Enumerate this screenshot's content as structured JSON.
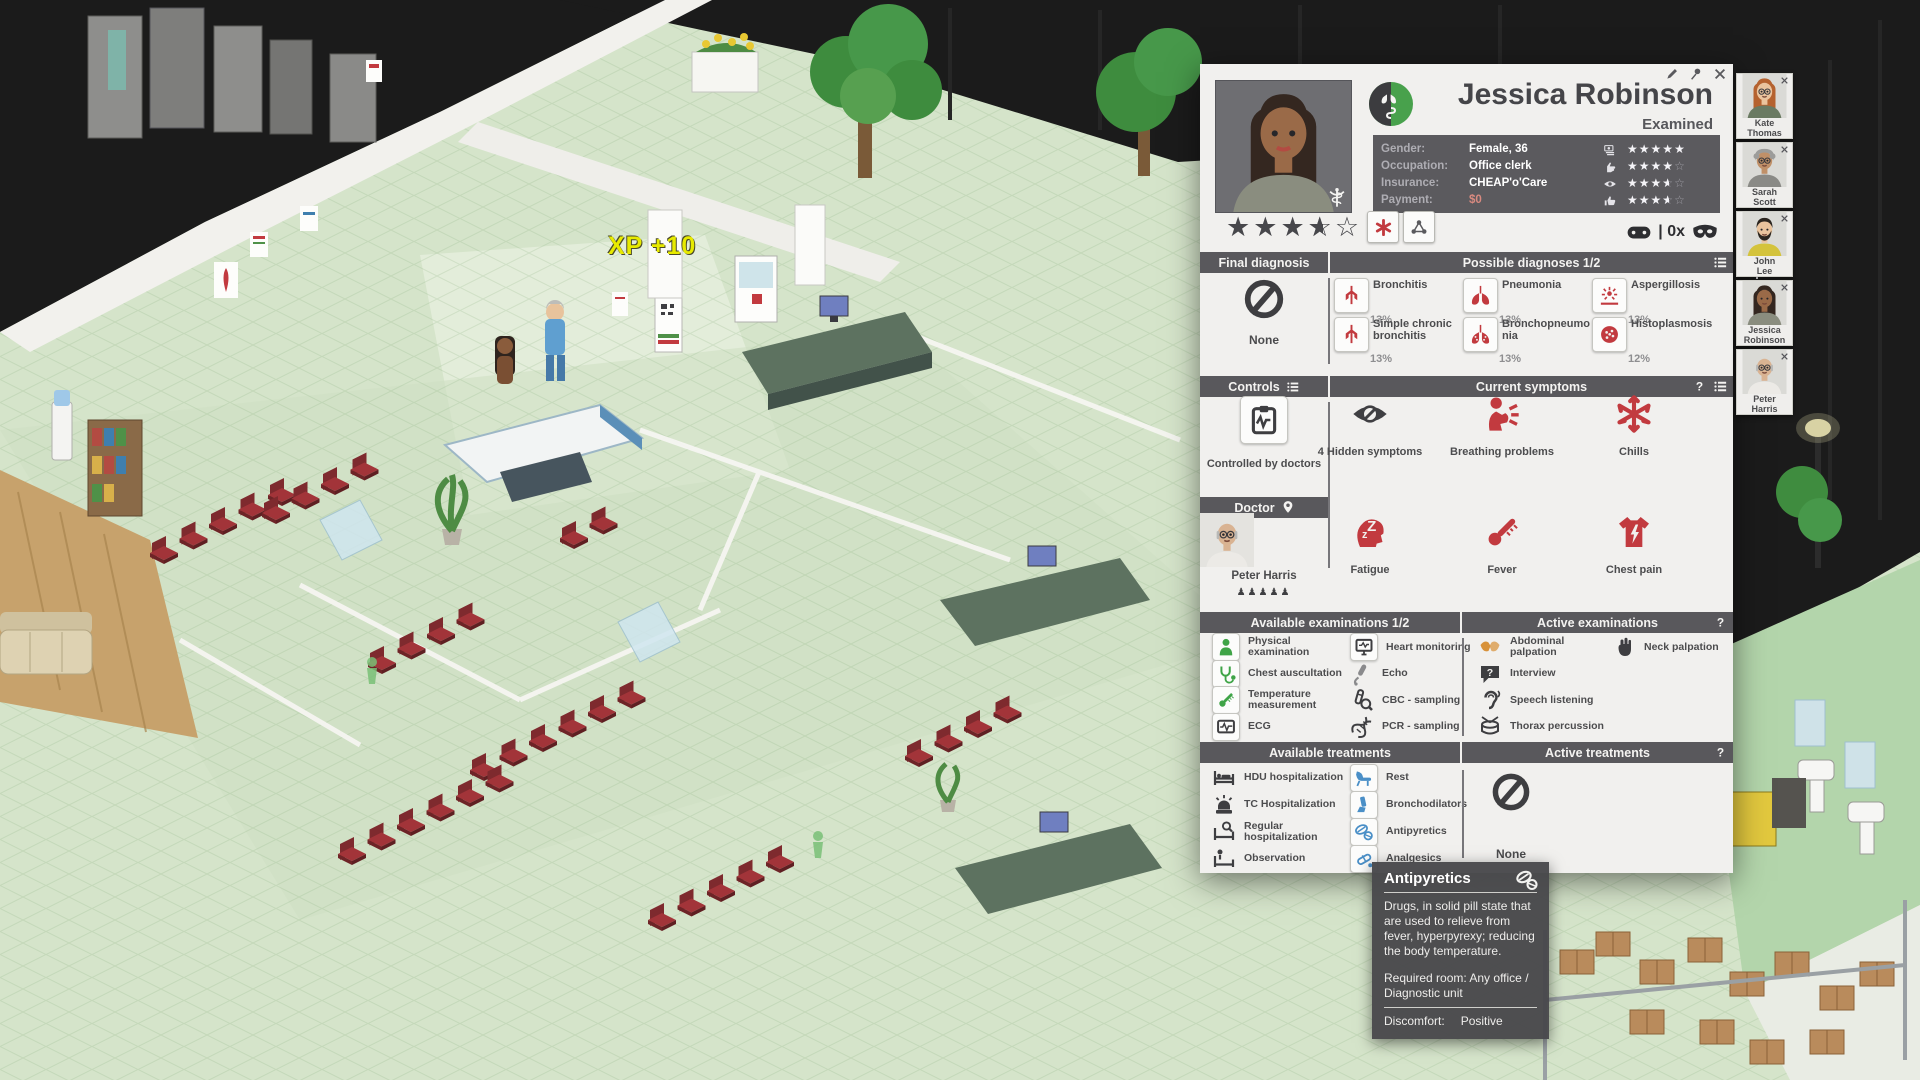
{
  "scene": {
    "xp_popup": "XP +10"
  },
  "panel": {
    "window_buttons": [
      "edit-icon",
      "pin-icon",
      "close-icon"
    ],
    "title": "Jessica Robinson",
    "status": "Examined",
    "info": {
      "rows": [
        {
          "label": "Gender:",
          "value": "Female, 36",
          "icon": "money-icon",
          "stars": 5
        },
        {
          "label": "Occupation:",
          "value": "Office clerk",
          "icon": "hand-icon",
          "stars": 4
        },
        {
          "label": "Insurance:",
          "value": "CHEAP'o'Care",
          "icon": "eye-icon",
          "stars": 3.5
        },
        {
          "label": "Payment:",
          "value": "$0",
          "icon": "thumbs-up-icon",
          "stars": 3.5
        }
      ]
    },
    "patient_stars": 3.5,
    "meta_icons": {
      "controller_label": "| 0x"
    },
    "final_diagnosis": {
      "header": "Final diagnosis",
      "value": "None"
    },
    "possible_diagnoses": {
      "header": "Possible diagnoses 1/2",
      "items": [
        {
          "name": "Bronchitis",
          "probability": "13%",
          "icon": "bronchi-icon"
        },
        {
          "name": "Pneumonia",
          "probability": "13%",
          "icon": "lungs-icon"
        },
        {
          "name": "Aspergillosis",
          "probability": "13%",
          "icon": "spores-icon"
        },
        {
          "name": "Simple chronic bronchitis",
          "probability": "13%",
          "icon": "bronchi-icon"
        },
        {
          "name": "Bronchopneumonia",
          "probability": "13%",
          "icon": "lungs-dots-icon"
        },
        {
          "name": "Histoplasmosis",
          "probability": "12%",
          "icon": "cell-icon"
        }
      ]
    },
    "controls": {
      "header": "Controls",
      "value": "Controlled by doctors",
      "icon": "clipboard-icon"
    },
    "symptoms": {
      "header": "Current symptoms",
      "items": [
        {
          "name": "4 Hidden symptoms",
          "icon": "hidden-eye-icon",
          "tint": "#3f3f42"
        },
        {
          "name": "Breathing problems",
          "icon": "breathing-icon",
          "tint": "#c23a3f"
        },
        {
          "name": "Chills",
          "icon": "snowflake-icon",
          "tint": "#c23a3f"
        },
        {
          "name": "Fatigue",
          "icon": "fatigue-icon",
          "tint": "#c23a3f"
        },
        {
          "name": "Fever",
          "icon": "thermometer-icon",
          "tint": "#c23a3f"
        },
        {
          "name": "Chest pain",
          "icon": "chest-pain-icon",
          "tint": "#c23a3f"
        }
      ]
    },
    "doctor": {
      "header": "Doctor",
      "name": "Peter Harris",
      "seniority": 5
    },
    "examinations": {
      "available_header": "Available examinations 1/2",
      "active_header": "Active examinations",
      "available": [
        {
          "name": "Physical examination",
          "icon": "person-icon",
          "style": "framed-green"
        },
        {
          "name": "Chest auscultation",
          "icon": "stethoscope-icon",
          "style": "framed-green"
        },
        {
          "name": "Temperature measurement",
          "icon": "thermometer-icon",
          "style": "framed-green"
        },
        {
          "name": "ECG",
          "icon": "ecg-icon",
          "style": "framed-dark"
        },
        {
          "name": "Heart monitoring",
          "icon": "monitor-icon",
          "style": "framed-dark"
        },
        {
          "name": "Echo",
          "icon": "echo-icon",
          "style": "plain-grey"
        },
        {
          "name": "CBC - sampling",
          "icon": "test-tube-icon",
          "style": "plain-dark"
        },
        {
          "name": "PCR - sampling",
          "icon": "dna-icon",
          "style": "plain-dark"
        }
      ],
      "active": [
        {
          "name": "Abdominal palpation",
          "icon": "hands-icon",
          "style": "plain-orange"
        },
        {
          "name": "Interview",
          "icon": "speech-bubble-icon",
          "style": "plain-dark"
        },
        {
          "name": "Speech listening",
          "icon": "ear-icon",
          "style": "plain-dark"
        },
        {
          "name": "Thorax percussion",
          "icon": "drum-icon",
          "style": "plain-dark"
        },
        {
          "name": "Neck palpation",
          "icon": "palpation-hand-icon",
          "style": "plain-dark"
        }
      ]
    },
    "treatments": {
      "available_header": "Available treatments",
      "active_header": "Active treatments",
      "available": [
        {
          "name": "HDU hospitalization",
          "icon": "bed-icon",
          "style": "plain-dark"
        },
        {
          "name": "TC Hospitalization",
          "icon": "siren-icon",
          "style": "plain-dark"
        },
        {
          "name": "Regular hospitalization",
          "icon": "bed-search-icon",
          "style": "plain-dark"
        },
        {
          "name": "Observation",
          "icon": "bed-person-icon",
          "style": "plain-dark"
        },
        {
          "name": "Rest",
          "icon": "rest-chair-icon",
          "style": "framed-blue"
        },
        {
          "name": "Bronchodilators",
          "icon": "inhaler-icon",
          "style": "framed-blue"
        },
        {
          "name": "Antipyretics",
          "icon": "pills-icon",
          "style": "framed-blue"
        },
        {
          "name": "Analgesics",
          "icon": "capsule-icon",
          "style": "framed-blue"
        }
      ],
      "active_value": "None"
    },
    "colors": {
      "accent_red": "#c23a3f",
      "accent_green": "#3fa447",
      "accent_blue": "#4a8fc7",
      "bar": "#59585c",
      "panel_bg": "#f1f0ee"
    }
  },
  "tooltip": {
    "title": "Antipyretics",
    "icon": "pills-icon",
    "description": "Drugs, in solid pill state that are used to relieve from fever, hyperpyrexy; reducing the body temperature.",
    "required_room": "Required room: Any office / Diagnostic unit",
    "discomfort_label": "Discomfort:",
    "discomfort_value": "Positive"
  },
  "queue": {
    "patients": [
      {
        "name": "Kate Thomas"
      },
      {
        "name": "Sarah Scott"
      },
      {
        "name": "John Lee"
      },
      {
        "name": "Jessica Robinson"
      },
      {
        "name": "Peter Harris"
      }
    ]
  }
}
